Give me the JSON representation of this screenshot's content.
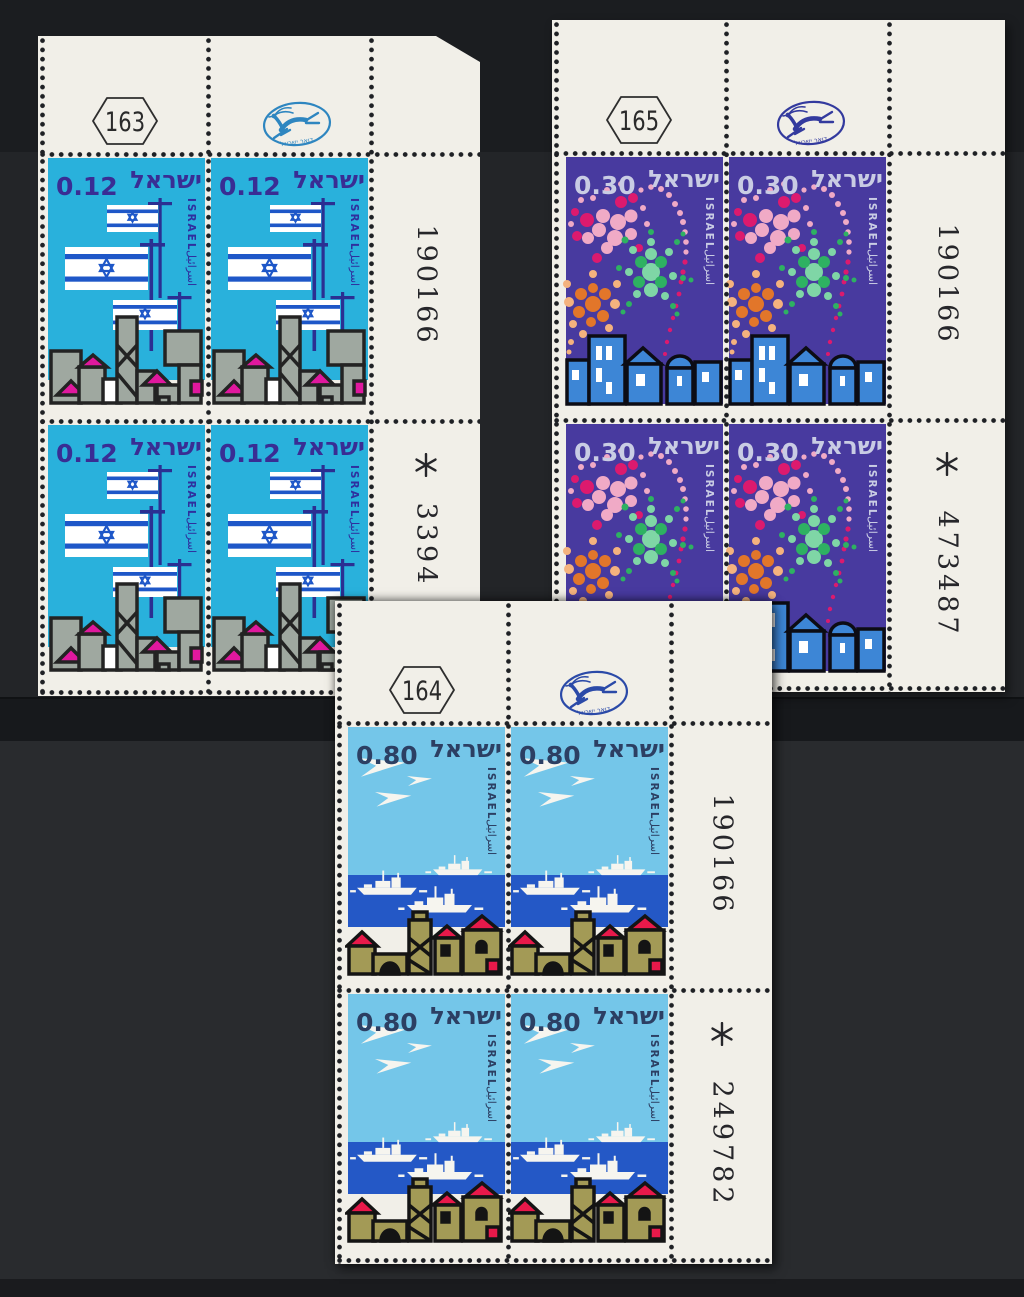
{
  "scene": {
    "background_color": "#232528",
    "paper_color": "#f1efe8"
  },
  "postal_logo": {
    "label": "דואר ישראל"
  },
  "blocks": [
    {
      "plate_number": "163",
      "serial_number": "190166",
      "control_mark": "✻",
      "control_number": "3394",
      "stamp": {
        "denomination": "0.12",
        "country_hebrew": "ישראל",
        "country_latin": "ISRAEL",
        "country_arabic": "اسرائيل",
        "design": "israeli-flags-over-town",
        "background_color": "#29b1dc",
        "ink_color": "#392d94",
        "accent_colors": [
          "#1e57c8",
          "#9fa8a0",
          "#e0189e"
        ]
      }
    },
    {
      "plate_number": "165",
      "serial_number": "190166",
      "control_mark": "✻",
      "control_number": "473487",
      "stamp": {
        "denomination": "0.30",
        "country_hebrew": "ישראל",
        "country_latin": "ISRAEL",
        "country_arabic": "اسرائيل",
        "design": "fireworks-over-night-town",
        "background_color": "#483a9f",
        "ink_color": "#c9cce4",
        "accent_colors": [
          "#f0aac6",
          "#dc1a6e",
          "#7fd6a6",
          "#2eb162",
          "#e2762a",
          "#f4b27e",
          "#3d86d6"
        ]
      }
    },
    {
      "plate_number": "164",
      "serial_number": "190166",
      "control_mark": "✻",
      "control_number": "249782",
      "stamp": {
        "denomination": "0.80",
        "country_hebrew": "ישראל",
        "country_latin": "ISRAEL",
        "country_arabic": "اسرائيل",
        "design": "jets-ships-and-town",
        "background_color": "#74c6e9",
        "ink_color": "#2c3f63",
        "accent_colors": [
          "#2458c6",
          "#a39a56",
          "#e8194a"
        ]
      }
    }
  ]
}
